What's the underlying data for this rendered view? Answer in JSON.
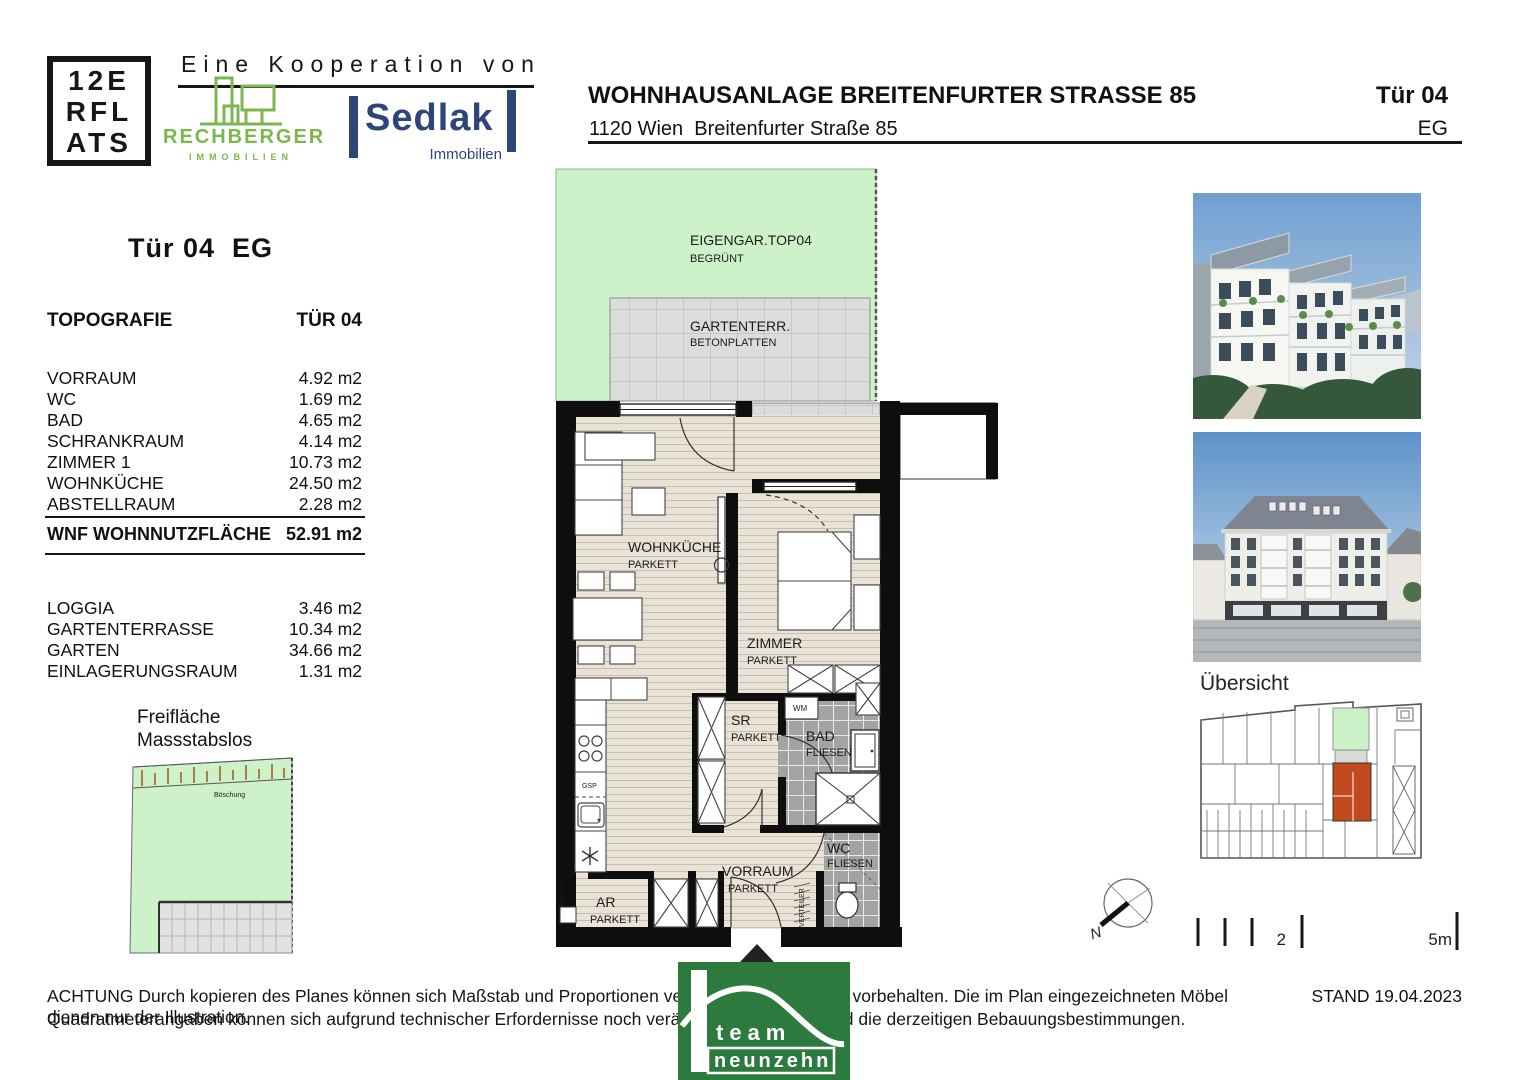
{
  "header": {
    "brand_lines": [
      "12E",
      "RFL",
      "ATS"
    ],
    "cooperation": "Eine Kooperation von",
    "rechberger_name": "RECHBERGER",
    "rechberger_sub": "IMMOBILIEN",
    "sedlak_name": "Sedlak",
    "sedlak_sub": "Immobilien",
    "project_title": "WOHNHAUSANLAGE BREITENFURTER STRASSE 85",
    "project_address": "1120 Wien  Breitenfurter Straße 85",
    "unit_label": "Tür 04",
    "floor_label": "EG"
  },
  "info": {
    "heading": "Tür 04  EG",
    "topo_header": "TOPOGRAFIE",
    "topo_unit": "TÜR 04",
    "rows": [
      {
        "label": "VORRAUM",
        "value": "4.92 m2"
      },
      {
        "label": "WC",
        "value": "1.69 m2"
      },
      {
        "label": "BAD",
        "value": "4.65 m2"
      },
      {
        "label": "SCHRANKRAUM",
        "value": "4.14 m2"
      },
      {
        "label": "ZIMMER 1",
        "value": "10.73 m2"
      },
      {
        "label": "WOHNKÜCHE",
        "value": "24.50 m2"
      },
      {
        "label": "ABSTELLRAUM",
        "value": "2.28 m2"
      }
    ],
    "total_label": "WNF WOHNNUTZFLÄCHE",
    "total_value": "52.91 m2",
    "outdoor_rows": [
      {
        "label": "LOGGIA",
        "value": "3.46 m2"
      },
      {
        "label": "GARTENTERRASSE",
        "value": "10.34 m2"
      },
      {
        "label": "GARTEN",
        "value": "34.66 m2"
      },
      {
        "label": "EINLAGERUNGSRAUM",
        "value": "1.31 m2"
      }
    ],
    "freiflaeche_line1": "Freifläche",
    "freiflaeche_line2": "Massstabslos",
    "boeschung": "Böschung"
  },
  "plan": {
    "garden_name": "EIGENGAR.TOP04",
    "garden_sub": "BEGRÜNT",
    "terrace_name": "GARTENTERR.",
    "terrace_sub": "BETONPLATTEN",
    "loggia_name": "LOGGIA",
    "loggia_sub": "BETONPLATTEN",
    "wohnkueche_name": "WOHNKÜCHE",
    "wohnkueche_sub": "PARKETT",
    "zimmer_name": "ZIMMER",
    "zimmer_sub": "PARKETT",
    "sr_name": "SR",
    "sr_sub": "PARKETT",
    "bad_name": "BAD",
    "bad_sub": "FLIESEN",
    "wc_name": "WC",
    "wc_sub": "FLIESEN",
    "vorraum_name": "VORRAUM",
    "vorraum_sub": "PARKETT",
    "ar_name": "AR",
    "ar_sub": "PARKETT",
    "wm": "WM",
    "gsp": "GSP",
    "verteiler": "VERTEILER",
    "stu": "STU H:15"
  },
  "overview": {
    "title": "Übersicht"
  },
  "compass": {
    "north": "N"
  },
  "scalebar": {
    "mid": "2",
    "end": "5m"
  },
  "footer": {
    "line1": "ACHTUNG Durch kopieren des Planes können sich Maßstab und Proportionen verändern. Änderungen vorbehalten. Die im Plan eingezeichneten Möbel dienen nur der Illustration.",
    "line2": "Quadratmeterangaben können sich aufgrund technischer Erfordernisse noch verändern. Grundlage sind die derzeitigen Bebauungsbestimmungen.",
    "stand": "STAND 19.04.2023",
    "logo_line1": "team",
    "logo_line2": "neunzehn"
  },
  "colors": {
    "garden_green": "#cdf2c9",
    "highlight_orange": "#c14a1e",
    "rechberger_green": "#7cb650",
    "sedlak_navy": "#2e4677",
    "team_green": "#2d7a3f"
  }
}
